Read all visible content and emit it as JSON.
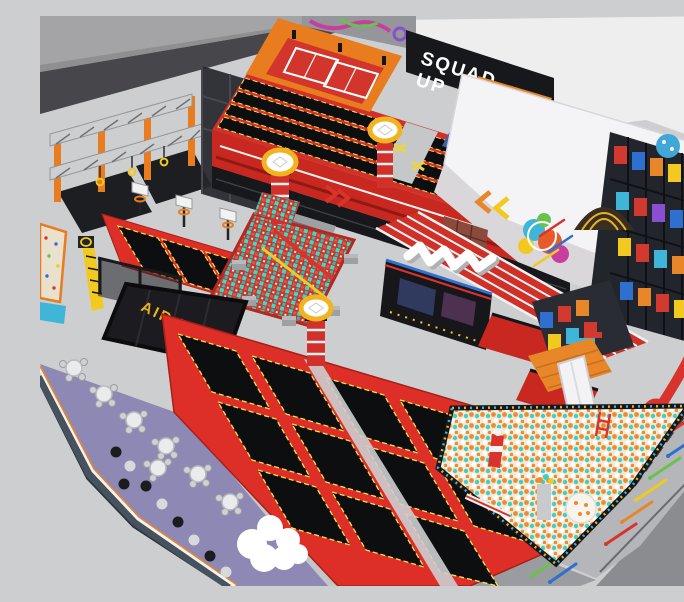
{
  "signs": {
    "squad_up": {
      "line1": "SQUAD",
      "line2": "UP"
    },
    "air_bag": "AIR BAG"
  },
  "palette": {
    "interior_floor": "#ccced0",
    "outside_floor": "#a4a4a6",
    "dark_wall": "#47474b",
    "cafe_floor": "#8e88b4",
    "cafe_wall": "#46525e",
    "trampoline_red": "#dd2f28",
    "trampoline_bed": "#0d0e10",
    "bed_trim_yellow": "#f5e44c",
    "foam_teal": "#3ed8cc",
    "foam_red": "#e85040",
    "track_red": "#cf3028",
    "orange": "#e8872a",
    "ninja_orange": "#e87c1e",
    "squad_wall_black": "#17181b",
    "sign_yellow": "#e8b422",
    "building_white": "#f4f4f6",
    "playground_frame": "#23252c",
    "checker_red": "#d03028",
    "ball_orange": "#ef8b2a",
    "ball_teal": "#3fd0c4",
    "ring_yellow": "#f2b31f",
    "sky_blue": "#3fb6d8",
    "purple_graffiti": "#c73f9e"
  },
  "zones": [
    {
      "name": "ninja-course",
      "color": "#e87c1e"
    },
    {
      "name": "climbing-wall",
      "color": "#e9e1cd"
    },
    {
      "name": "dunk-court",
      "color": "#dd2f28"
    },
    {
      "name": "air-bag-pit",
      "color": "#1c1c20"
    },
    {
      "name": "foam-cube-pit",
      "color": "#3ed8cc"
    },
    {
      "name": "performance-trampoline-deck",
      "color": "#d2302a"
    },
    {
      "name": "fencing-courts",
      "color": "#e87c1e"
    },
    {
      "name": "squad-up-wall",
      "color": "#17181b"
    },
    {
      "name": "stage-curtains",
      "color": "#c22b22"
    },
    {
      "name": "party-building",
      "color": "#f4f4f6"
    },
    {
      "name": "running-track",
      "color": "#cf3028"
    },
    {
      "name": "graffiti-sculpture",
      "color": "#ffffff"
    },
    {
      "name": "interactive-screen-wall",
      "color": "#17171b"
    },
    {
      "name": "main-trampoline-court",
      "color": "#dd2f28"
    },
    {
      "name": "jump-towers",
      "color": "#f2b31f"
    },
    {
      "name": "playground-structure",
      "color": "#23252c"
    },
    {
      "name": "checker-wall",
      "color": "#d03028"
    },
    {
      "name": "ball-pit",
      "color": "#ef8b2a"
    },
    {
      "name": "cafe-seating",
      "color": "#8e88b4"
    },
    {
      "name": "cloud-seat",
      "color": "#ffffff"
    },
    {
      "name": "walkway-darts",
      "color": "#b5b6b9"
    }
  ]
}
